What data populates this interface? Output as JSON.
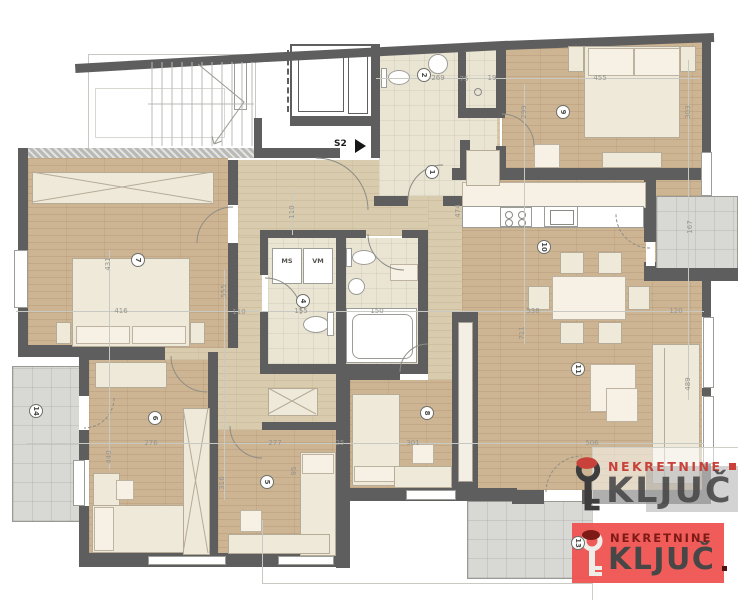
{
  "plan": {
    "entrance_label": "S2",
    "utility_labels": {
      "ms": "MS",
      "vm": "VM"
    },
    "room_numbers": [
      {
        "n": "1"
      },
      {
        "n": "2"
      },
      {
        "n": "4"
      },
      {
        "n": "5"
      },
      {
        "n": "6"
      },
      {
        "n": "7"
      },
      {
        "n": "8"
      },
      {
        "n": "9"
      },
      {
        "n": "10"
      },
      {
        "n": "11"
      },
      {
        "n": "13"
      },
      {
        "n": "14"
      }
    ],
    "dimensions": [
      {
        "v": "455"
      },
      {
        "v": "269"
      },
      {
        "v": "75"
      },
      {
        "v": "19"
      },
      {
        "v": "299"
      },
      {
        "v": "303"
      },
      {
        "v": "474"
      },
      {
        "v": "110"
      },
      {
        "v": "167"
      },
      {
        "v": "431"
      },
      {
        "v": "416"
      },
      {
        "v": "555"
      },
      {
        "v": "110"
      },
      {
        "v": "155"
      },
      {
        "v": "150"
      },
      {
        "v": "538"
      },
      {
        "v": "120"
      },
      {
        "v": "711"
      },
      {
        "v": "489"
      },
      {
        "v": "276"
      },
      {
        "v": "277"
      },
      {
        "v": "25"
      },
      {
        "v": "301"
      },
      {
        "v": "506"
      },
      {
        "v": "440"
      },
      {
        "v": "316"
      },
      {
        "v": "95"
      }
    ]
  },
  "watermarks": {
    "overlay_logo": {
      "line1": "NEKRETNINE",
      "line2": "KLJUČ"
    },
    "badge_logo": {
      "line1": "NEKRETNINE",
      "line2": "KLJUČ"
    }
  },
  "colors": {
    "wall": "#5e5e5e",
    "wood": "#cdb492",
    "tile": "#eae4d3",
    "terrace": "#d8d8d5",
    "brandRed": "#c8423b",
    "badgeBg": "#ee5350",
    "logoGray": "#4b4b4b"
  }
}
